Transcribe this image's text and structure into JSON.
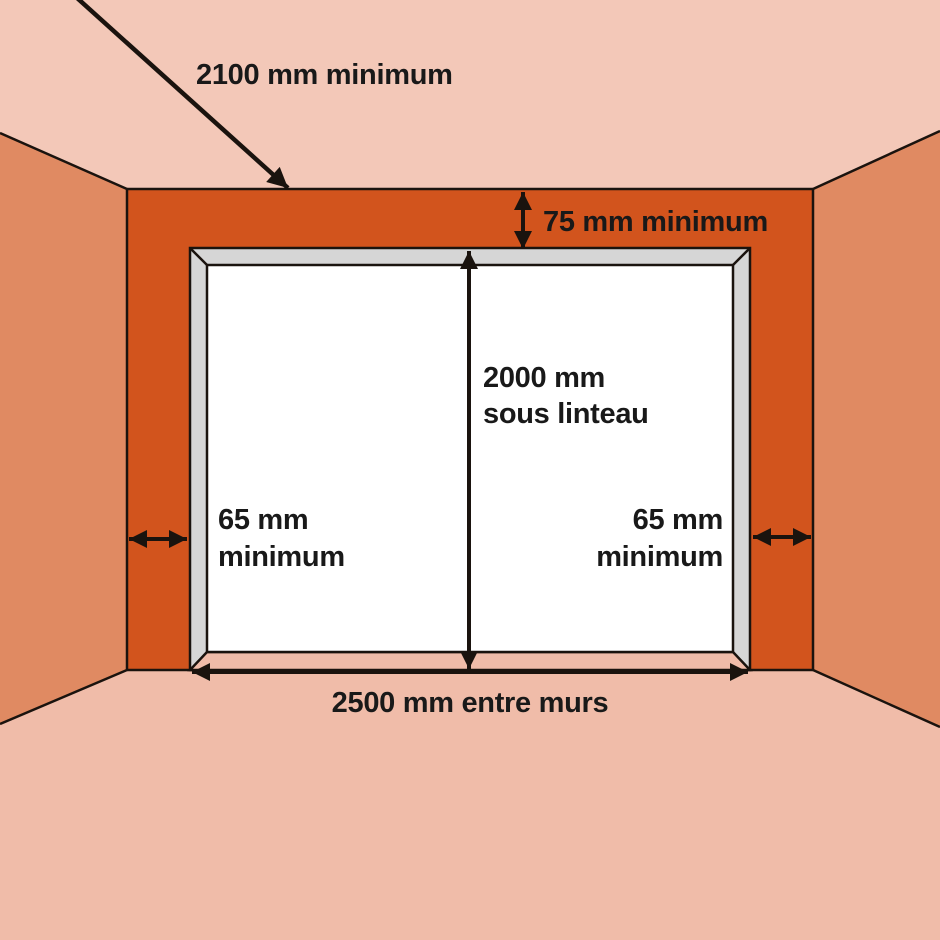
{
  "diagram": {
    "labels": {
      "depth_min": "2100 mm minimum",
      "lintel_min": "75 mm minimum",
      "height_value": "2000 mm",
      "height_caption": "sous linteau",
      "left_margin_value": "65 mm",
      "left_margin_caption": "minimum",
      "right_margin_value": "65 mm",
      "right_margin_caption": "minimum",
      "width_between_walls": "2500 mm entre murs"
    },
    "colors": {
      "ceiling": "#f3c8b8",
      "side_wall": "#e08a62",
      "front_wall": "#d2541d",
      "floor": "#f0bca9",
      "door_frame": "#d6d6d6",
      "door_panel": "#ffffff",
      "outline": "#1a130e",
      "text": "#191919"
    }
  }
}
